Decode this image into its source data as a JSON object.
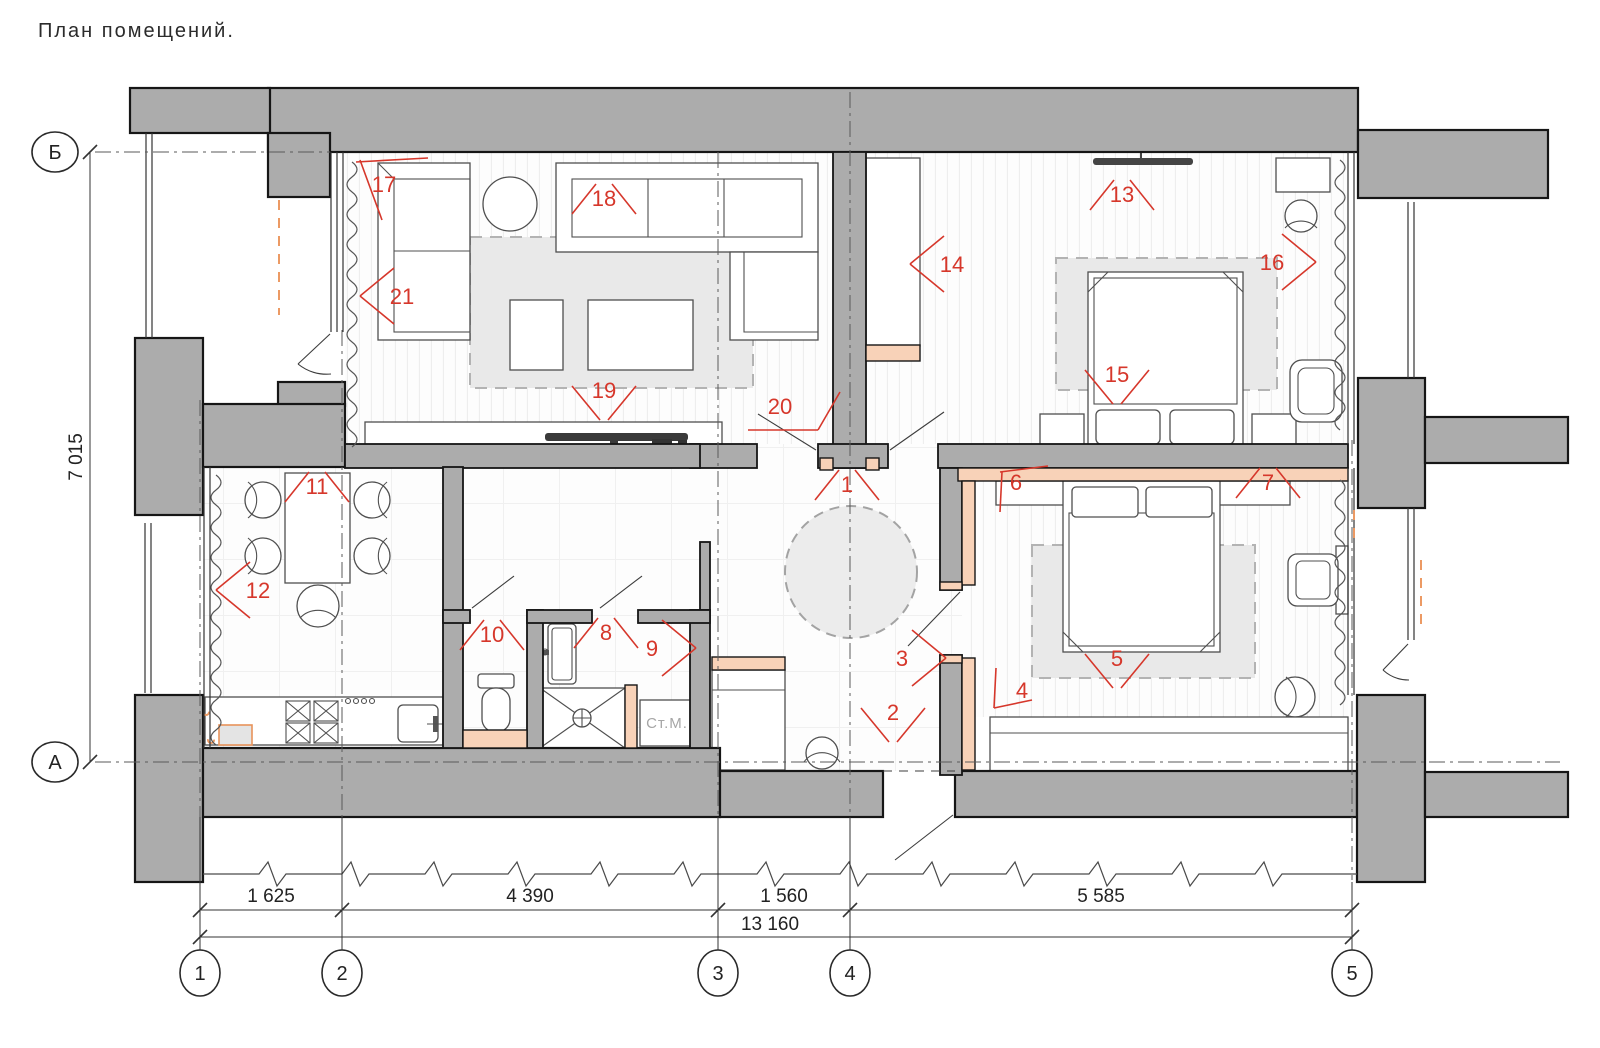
{
  "title": "План помещений.",
  "axes": {
    "horizontal": [
      "1",
      "2",
      "3",
      "4",
      "5"
    ],
    "vertical": [
      "Б",
      "А"
    ]
  },
  "dimensions": {
    "width_segments": [
      "1 625",
      "4 390",
      "1 560",
      "5 585"
    ],
    "width_total": "13 160",
    "height_left": "7 015"
  },
  "labels": {
    "washing_machine": "Ст.М."
  },
  "colors": {
    "wall_gray": "#acacac",
    "built_in_peach": "#f8d2b8",
    "marker_red": "#d6372b",
    "rug_gray": "#e9e9e9"
  },
  "markers": [
    {
      "n": "1",
      "x": 847,
      "y": 478,
      "dir": "up"
    },
    {
      "n": "2",
      "x": 893,
      "y": 724,
      "dir": "down"
    },
    {
      "n": "3",
      "x": 918,
      "y": 658,
      "dir": "right"
    },
    {
      "n": "4",
      "x": 1008,
      "y": 698,
      "dir": "corner-u"
    },
    {
      "n": "5",
      "x": 1117,
      "y": 670,
      "dir": "down"
    },
    {
      "n": "6",
      "x": 1000,
      "y": 480,
      "dir": "corner-d"
    },
    {
      "n": "7",
      "x": 1268,
      "y": 476,
      "dir": "up"
    },
    {
      "n": "8",
      "x": 606,
      "y": 626,
      "dir": "up"
    },
    {
      "n": "9",
      "x": 668,
      "y": 648,
      "dir": "right"
    },
    {
      "n": "10",
      "x": 492,
      "y": 628,
      "dir": "up"
    },
    {
      "n": "11",
      "x": 317,
      "y": 480,
      "dir": "up"
    },
    {
      "n": "12",
      "x": 244,
      "y": 590,
      "dir": "left"
    },
    {
      "n": "13",
      "x": 1122,
      "y": 188,
      "dir": "up"
    },
    {
      "n": "14",
      "x": 938,
      "y": 264,
      "dir": "left"
    },
    {
      "n": "15",
      "x": 1117,
      "y": 386,
      "dir": "down"
    },
    {
      "n": "16",
      "x": 1288,
      "y": 262,
      "dir": "right"
    },
    {
      "n": "17",
      "x": 382,
      "y": 186,
      "dir": "flag-dl"
    },
    {
      "n": "18",
      "x": 604,
      "y": 192,
      "dir": "up"
    },
    {
      "n": "19",
      "x": 604,
      "y": 402,
      "dir": "down"
    },
    {
      "n": "20",
      "x": 778,
      "y": 416,
      "dir": "flag-ur"
    },
    {
      "n": "21",
      "x": 388,
      "y": 296,
      "dir": "left"
    }
  ]
}
